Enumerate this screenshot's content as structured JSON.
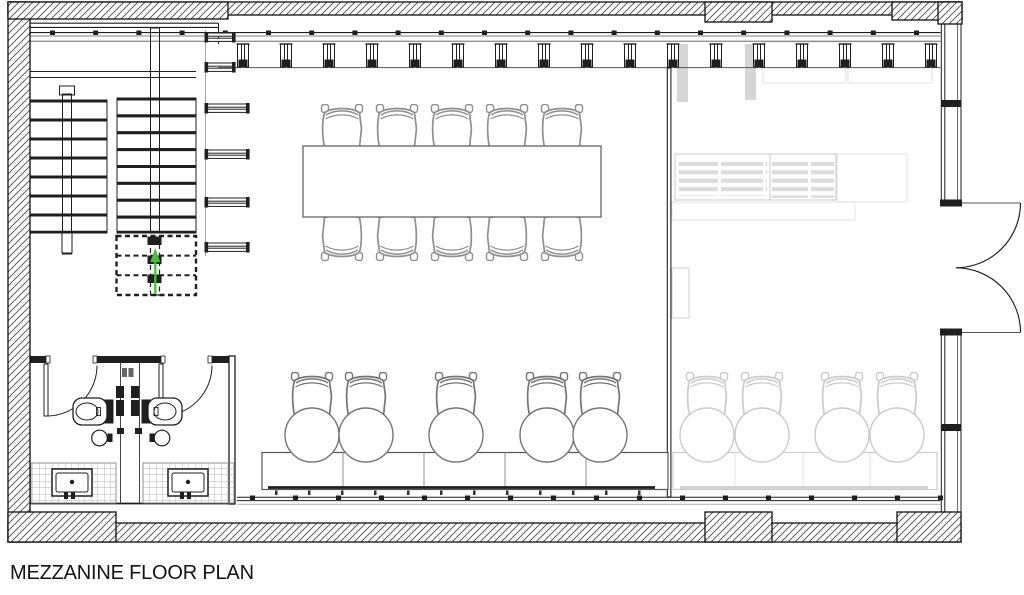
{
  "title_block": {
    "label": "MEZZANINE FLOOR PLAN"
  },
  "drawing": {
    "type": "architectural_floor_plan",
    "level": "mezzanine",
    "colors": {
      "line": "#1f1f1f",
      "mid": "#555555",
      "furniture": "#8a8a8a",
      "conference_chair": "#8f8f8f",
      "desk_chair": "#747474",
      "ghost": "#cbcbcb",
      "ghost_light": "#dddddd",
      "hatch": "#474747",
      "stair_arrow": "#44c136"
    },
    "mullions_top": {
      "start": 243,
      "step": 43,
      "count": 17,
      "y": 44
    },
    "sill_ticks_top": {
      "start": 50,
      "step": 43.2,
      "count": 21,
      "y": 30.5
    },
    "sill_ticks_bottom": {
      "start": 250,
      "step": 43,
      "count": 17,
      "y": 495.5
    },
    "stairs": {
      "direction": "up",
      "left_flight": {
        "x": 28,
        "width": 79,
        "top": 100,
        "step": 19,
        "count": 7
      },
      "right_flight": {
        "x": 117,
        "width": 79,
        "top": 98,
        "step": 16.875,
        "count": 8
      },
      "dashed_treads_below_cut": 3
    },
    "shelf_benches": {
      "ys": [
        33,
        63,
        104,
        150,
        198,
        243
      ],
      "widths": [
        26,
        26,
        40,
        40,
        40,
        40
      ]
    },
    "conference": {
      "table": {
        "x": 303,
        "y": 146,
        "w": 298,
        "h": 71
      },
      "chair_cx": [
        342,
        397,
        452,
        507,
        562
      ],
      "chairs_top_y": 104,
      "chairs_bottom_y": 215,
      "seats": 10
    },
    "workstations": {
      "dark": {
        "chair_cx": [
          312,
          366,
          456,
          547,
          600
        ],
        "chair_y": 372,
        "circle_cy": 435,
        "circle_r": 27
      },
      "ghost": {
        "chair_cx": [
          707,
          762,
          842,
          897
        ],
        "chair_y": 372,
        "circle_cy": 435,
        "circle_r": 27
      }
    },
    "bathrooms": {
      "count": 2,
      "fixtures_each": [
        "swing door",
        "toilet",
        "washbasin",
        "vanity sink",
        "tiled floor"
      ]
    },
    "door_right": {
      "type": "double swing door",
      "leaves": 2
    },
    "ghost_furniture": [
      "columns",
      "storage grids",
      "slatted shelving",
      "4 workstations"
    ]
  }
}
